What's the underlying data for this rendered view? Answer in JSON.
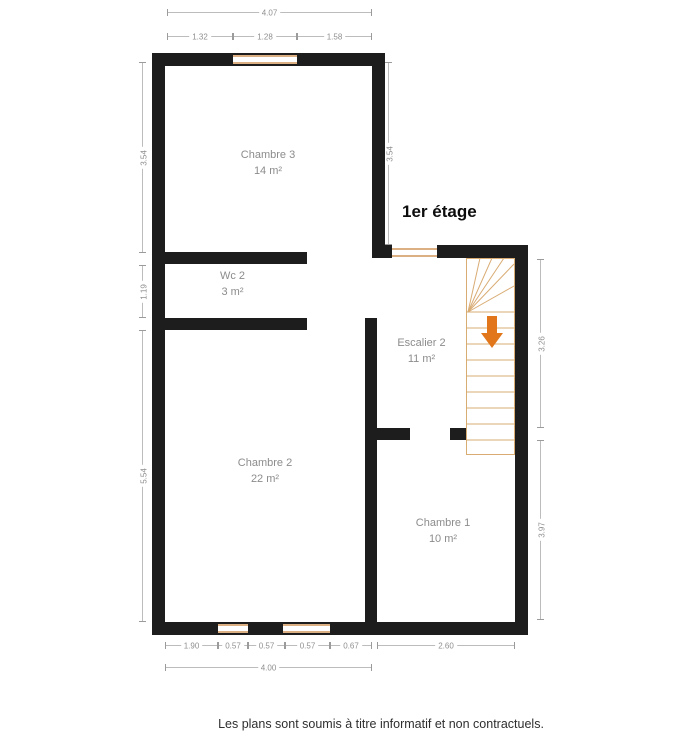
{
  "title": "1er étage",
  "rooms": [
    {
      "name": "Chambre 3",
      "area": "14 m²"
    },
    {
      "name": "Wc 2",
      "area": "3 m²"
    },
    {
      "name": "Escalier 2",
      "area": "11 m²"
    },
    {
      "name": "Chambre 2",
      "area": "22 m²"
    },
    {
      "name": "Chambre 1",
      "area": "10 m²"
    }
  ],
  "dimensions": {
    "top_total": "4.07",
    "top_segments": [
      "1.32",
      "1.28",
      "1.58"
    ],
    "left_chambre3": "3.54",
    "left_wc": "1.19",
    "left_chambre2": "5.54",
    "inner_chambre3_right": "3.54",
    "right_escalier": "3.26",
    "right_chambre1": "3.97",
    "bottom_segments": [
      "1.90",
      "0.57",
      "0.57",
      "0.57",
      "0.67"
    ],
    "bottom_chambre1": "2.60",
    "bottom_total": "4.00"
  },
  "icons": {
    "stairs_direction": "down-arrow"
  },
  "colors": {
    "wall": "#1d1d1d",
    "joinery_tan": "#ddb083",
    "stairs_arrow_orange": "#e2761b",
    "dimension_gray": "#9b9b9b",
    "label_gray": "#8c8c8c"
  },
  "footer": {
    "disclaimer": "Les plans sont soumis à titre informatif et non contractuels."
  }
}
